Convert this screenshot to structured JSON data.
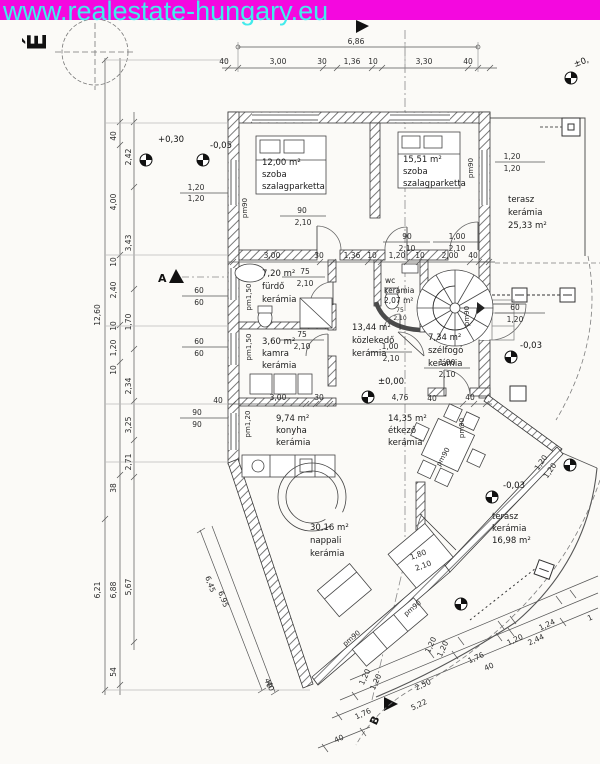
{
  "banner": {
    "url": "www.realestate-hungary.eu",
    "bg_color": "#f408df",
    "text_color": "#43ebec"
  },
  "compass": {
    "north": "É"
  },
  "markers": {
    "a": "A",
    "b": "B"
  },
  "levels": {
    "plus030": "+0,30",
    "minus005": "-0,05",
    "pm0": "±0,",
    "pm000": "±0,00",
    "minus003a": "-0,03",
    "minus003b": "-0,03"
  },
  "rooms": {
    "szoba1": {
      "area": "12,00 m²",
      "name": "szoba",
      "floor": "szalagparketta"
    },
    "szoba2": {
      "area": "15,51 m²",
      "name": "szoba",
      "floor": "szalagparketta"
    },
    "furdo": {
      "area": "7,20 m²",
      "name": "fürdő",
      "floor": "kerámia"
    },
    "wc": {
      "name": "wc",
      "floor": "kerámia",
      "area": "2,07 m²"
    },
    "kozlekedo": {
      "area": "13,44 m²",
      "name": "közlekedő",
      "floor": "kerámia"
    },
    "szelfogo": {
      "area": "7,34 m²",
      "name": "szélfogó",
      "floor": "kerámia"
    },
    "kamra": {
      "area": "3,60 m²",
      "name": "kamra",
      "floor": "kerámia"
    },
    "konyha": {
      "area": "9,74 m²",
      "name": "konyha",
      "floor": "kerámia"
    },
    "etkezo": {
      "area": "14,35 m²",
      "name": "étkező",
      "floor": "kerámia"
    },
    "nappali": {
      "area": "30,16 m²",
      "name": "nappali",
      "floor": "kerámia"
    },
    "terasz1": {
      "name": "terasz",
      "floor": "kerámia",
      "area": "25,33 m²"
    },
    "terasz2": {
      "name": "terasz",
      "floor": "kerámia",
      "area": "16,98 m²"
    }
  },
  "parapets": {
    "pm90": "pm90",
    "pm150": "pm1,50",
    "pm120": "pm1,20"
  },
  "dims": {
    "total_top": "6,86",
    "top": [
      "40",
      "3,00",
      "30",
      "1,36",
      "10",
      "3,30",
      "40"
    ],
    "mid": [
      "3,00",
      "30",
      "1,36",
      "10",
      "1,20",
      "10",
      "2,00",
      "40"
    ],
    "kitchen": [
      "3,00",
      "30",
      "4,76",
      "40"
    ],
    "left_outer": [
      "12,60",
      "6,21"
    ],
    "left_mid": [
      "40",
      "4,00",
      "10",
      "2,40",
      "10",
      "1,20",
      "10",
      "38",
      "6,88",
      "54"
    ],
    "left_inner": [
      "2,42",
      "3,43",
      "1,70",
      "2,34",
      "3,25",
      "2,71",
      "5,67"
    ],
    "diag_sw": [
      "6,45",
      "6,95",
      "40"
    ],
    "bottom": [
      "1,20",
      "1,20",
      "1,76",
      "40",
      "1,20",
      "2,44",
      "1,24",
      "2,50",
      "5,22",
      "1,76",
      "40",
      "40",
      "1"
    ],
    "vals": {
      "v40": "40",
      "v60": "60",
      "v75": "75",
      "v90": "90",
      "v100": "1,00",
      "v120": "1,20",
      "v180": "1,80",
      "v210": "2,10"
    }
  }
}
